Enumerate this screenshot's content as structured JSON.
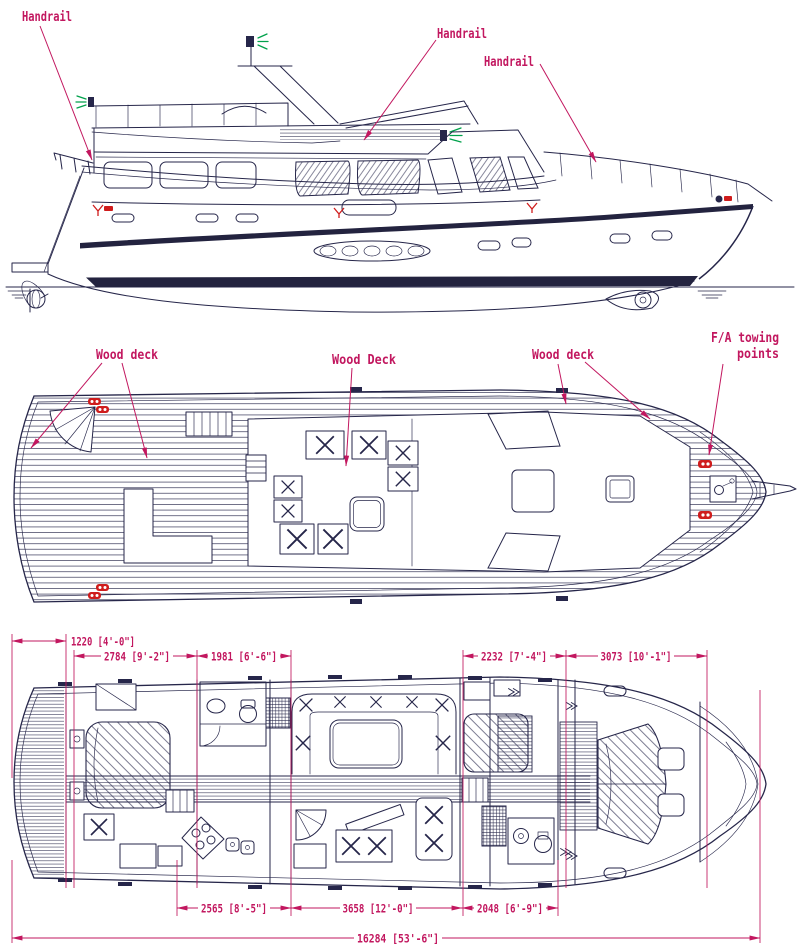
{
  "drawing_type": "yacht general arrangement",
  "colors": {
    "annotation_magenta": "#c2175f",
    "line_navy": "#26264a",
    "fitting_red": "#cf1c1c",
    "nav_light_green": "#00a14b",
    "background": "#ffffff"
  },
  "annotations": {
    "handrail_aft": "Handrail",
    "handrail_flybridge": "Handrail",
    "handrail_foredeck": "Handrail",
    "wood_deck_aft": "Wood deck",
    "wood_deck_mid": "Wood Deck",
    "wood_deck_fore": "Wood deck",
    "towing_line1": "F/A towing",
    "towing_line2": "points"
  },
  "dimensions": {
    "upper": [
      {
        "text": "1220 [4'-0\"]"
      },
      {
        "text": "2784 [9'-2\"]"
      },
      {
        "text": "1981 [6'-6\"]"
      },
      {
        "text": "2232 [7'-4\"]"
      },
      {
        "text": "3073 [10'-1\"]"
      }
    ],
    "lower": [
      {
        "text": "2565 [8'-5\"]"
      },
      {
        "text": "3658 [12'-0\"]"
      },
      {
        "text": "2048 [6'-9\"]"
      }
    ],
    "overall": {
      "text": "16284 [53'-6\"]"
    }
  }
}
